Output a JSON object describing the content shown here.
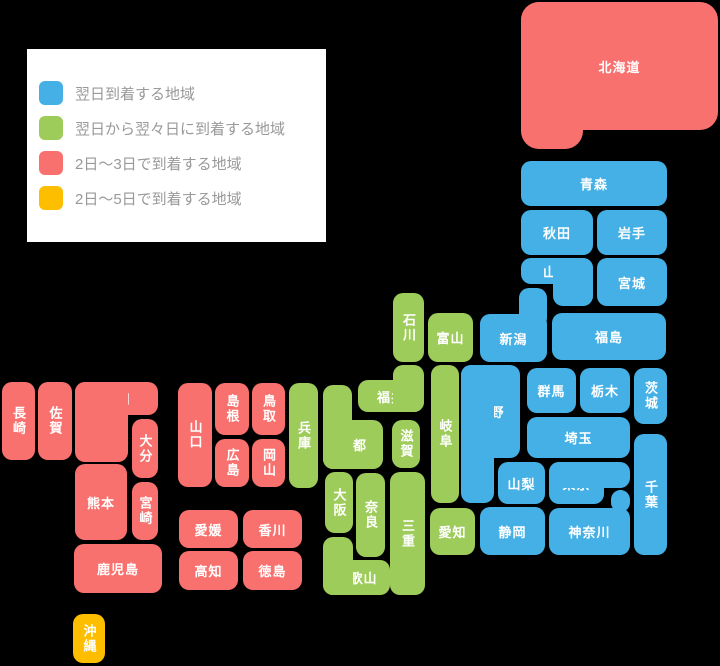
{
  "canvas": {
    "width": 720,
    "height": 666,
    "background": "#000000"
  },
  "colors": {
    "next_day": "#45B0E5",
    "next_next_day": "#9ECC5A",
    "two_three_days": "#F9716E",
    "two_five_days": "#FDBE00",
    "legend_background": "#FFFFFF",
    "legend_text": "#999999",
    "block_label": "#FFFFFF"
  },
  "legend": {
    "items": [
      {
        "key": "next_day",
        "label": "翌日到着する地域",
        "color": "#45B0E5"
      },
      {
        "key": "next_next_day",
        "label": "翌日から翌々日に到着する地域",
        "color": "#9ECC5A"
      },
      {
        "key": "two_three_days",
        "label": "2日〜3日で到着する地域",
        "color": "#F9716E"
      },
      {
        "key": "two_five_days",
        "label": "2日〜5日で到着する地域",
        "color": "#FDBE00"
      }
    ]
  },
  "map": {
    "prefectures": [
      {
        "name": "hokkaido",
        "label": "北海道",
        "delivery": "two_three_days",
        "radius": 18,
        "vertical": false,
        "rects": [
          [
            521,
            2,
            197,
            128
          ],
          [
            521,
            2,
            62,
            147
          ]
        ]
      },
      {
        "name": "aomori",
        "label": "青森",
        "delivery": "next_day",
        "vertical": false,
        "rects": [
          [
            521,
            161,
            146,
            45
          ]
        ]
      },
      {
        "name": "akita",
        "label": "秋田",
        "delivery": "next_day",
        "vertical": false,
        "rects": [
          [
            521,
            210,
            72,
            45
          ]
        ]
      },
      {
        "name": "iwate",
        "label": "岩手",
        "delivery": "next_day",
        "vertical": false,
        "rects": [
          [
            597,
            210,
            70,
            45
          ]
        ]
      },
      {
        "name": "yamagata",
        "label": "山形",
        "delivery": "next_day",
        "vertical": false,
        "rects": [
          [
            521,
            258,
            72,
            26
          ],
          [
            553,
            258,
            40,
            48
          ]
        ]
      },
      {
        "name": "miyagi",
        "label": "宮城",
        "delivery": "next_day",
        "vertical": false,
        "rects": [
          [
            597,
            258,
            70,
            48
          ]
        ]
      },
      {
        "name": "fukushima",
        "label": "福島",
        "delivery": "next_day",
        "vertical": false,
        "rects": [
          [
            552,
            313,
            114,
            47
          ]
        ]
      },
      {
        "name": "niigata",
        "label": "新潟",
        "delivery": "next_day",
        "vertical": false,
        "rects": [
          [
            480,
            314,
            67,
            48
          ],
          [
            519,
            288,
            28,
            40
          ]
        ]
      },
      {
        "name": "gunma",
        "label": "群馬",
        "delivery": "next_day",
        "vertical": false,
        "rects": [
          [
            527,
            368,
            49,
            45
          ]
        ]
      },
      {
        "name": "tochigi",
        "label": "栃木",
        "delivery": "next_day",
        "vertical": false,
        "rects": [
          [
            580,
            368,
            50,
            45
          ]
        ]
      },
      {
        "name": "ibaraki",
        "label": "茨城",
        "delivery": "next_day",
        "vertical": true,
        "rects": [
          [
            634,
            368,
            33,
            56
          ]
        ]
      },
      {
        "name": "saitama",
        "label": "埼玉",
        "delivery": "next_day",
        "vertical": false,
        "rects": [
          [
            527,
            417,
            103,
            41
          ]
        ]
      },
      {
        "name": "nagano",
        "label": "長野",
        "delivery": "next_day",
        "vertical": false,
        "rects": [
          [
            461,
            365,
            59,
            93
          ],
          [
            461,
            365,
            33,
            138
          ]
        ]
      },
      {
        "name": "yamanashi",
        "label": "山梨",
        "delivery": "next_day",
        "vertical": false,
        "rects": [
          [
            498,
            462,
            47,
            42
          ]
        ]
      },
      {
        "name": "tokyo",
        "label": "東京",
        "delivery": "next_day",
        "vertical": false,
        "rects": [
          [
            549,
            462,
            55,
            42
          ],
          [
            549,
            462,
            81,
            26
          ]
        ]
      },
      {
        "name": "chiba",
        "label": "千葉",
        "delivery": "next_day",
        "vertical": true,
        "rects": [
          [
            634,
            434,
            33,
            121
          ]
        ]
      },
      {
        "name": "shizuoka",
        "label": "静岡",
        "delivery": "next_day",
        "vertical": false,
        "rects": [
          [
            480,
            507,
            65,
            48
          ]
        ]
      },
      {
        "name": "kanagawa",
        "label": "神奈川",
        "delivery": "next_day",
        "vertical": false,
        "rects": [
          [
            549,
            508,
            81,
            47
          ],
          [
            611,
            490,
            19,
            22
          ]
        ]
      },
      {
        "name": "ishikawa",
        "label": "石川",
        "delivery": "next_next_day",
        "vertical": true,
        "rects": [
          [
            393,
            293,
            31,
            69
          ]
        ]
      },
      {
        "name": "toyama",
        "label": "富山",
        "delivery": "next_next_day",
        "vertical": false,
        "rects": [
          [
            428,
            313,
            45,
            49
          ]
        ]
      },
      {
        "name": "fukui",
        "label": "福井",
        "delivery": "next_next_day",
        "vertical": false,
        "rects": [
          [
            358,
            380,
            66,
            32
          ],
          [
            393,
            365,
            31,
            47
          ]
        ]
      },
      {
        "name": "gifu",
        "label": "岐阜",
        "delivery": "next_next_day",
        "vertical": true,
        "rects": [
          [
            431,
            365,
            28,
            138
          ]
        ]
      },
      {
        "name": "aichi",
        "label": "愛知",
        "delivery": "next_next_day",
        "vertical": false,
        "rects": [
          [
            430,
            508,
            45,
            47
          ]
        ]
      },
      {
        "name": "shiga",
        "label": "滋賀",
        "delivery": "next_next_day",
        "vertical": true,
        "rects": [
          [
            392,
            420,
            28,
            48
          ]
        ]
      },
      {
        "name": "mie",
        "label": "三重",
        "delivery": "next_next_day",
        "vertical": true,
        "rects": [
          [
            390,
            472,
            35,
            123
          ]
        ]
      },
      {
        "name": "kyoto",
        "label": "京都",
        "delivery": "next_next_day",
        "vertical": false,
        "rects": [
          [
            323,
            420,
            60,
            49
          ],
          [
            323,
            385,
            29,
            84
          ]
        ]
      },
      {
        "name": "osaka",
        "label": "大阪",
        "delivery": "next_next_day",
        "vertical": true,
        "rects": [
          [
            325,
            472,
            28,
            61
          ]
        ]
      },
      {
        "name": "nara",
        "label": "奈良",
        "delivery": "next_next_day",
        "vertical": true,
        "rects": [
          [
            356,
            473,
            29,
            84
          ]
        ]
      },
      {
        "name": "wakayama",
        "label": "和歌山",
        "delivery": "next_next_day",
        "vertical": false,
        "rects": [
          [
            323,
            560,
            67,
            35
          ],
          [
            323,
            537,
            30,
            58
          ]
        ]
      },
      {
        "name": "hyogo",
        "label": "兵庫",
        "delivery": "next_next_day",
        "vertical": true,
        "rects": [
          [
            289,
            383,
            29,
            105
          ]
        ]
      },
      {
        "name": "tottori",
        "label": "鳥取",
        "delivery": "two_three_days",
        "vertical": true,
        "rects": [
          [
            252,
            383,
            33,
            52
          ]
        ]
      },
      {
        "name": "shimane",
        "label": "島根",
        "delivery": "two_three_days",
        "vertical": true,
        "rects": [
          [
            215,
            383,
            34,
            52
          ]
        ]
      },
      {
        "name": "okayama",
        "label": "岡山",
        "delivery": "two_three_days",
        "vertical": true,
        "rects": [
          [
            252,
            439,
            33,
            48
          ]
        ]
      },
      {
        "name": "hiroshima",
        "label": "広島",
        "delivery": "two_three_days",
        "vertical": true,
        "rects": [
          [
            215,
            439,
            34,
            48
          ]
        ]
      },
      {
        "name": "yamaguchi",
        "label": "山口",
        "delivery": "two_three_days",
        "vertical": true,
        "rects": [
          [
            178,
            383,
            34,
            104
          ]
        ]
      },
      {
        "name": "kagawa",
        "label": "香川",
        "delivery": "two_three_days",
        "vertical": false,
        "rects": [
          [
            243,
            510,
            59,
            38
          ]
        ]
      },
      {
        "name": "ehime",
        "label": "愛媛",
        "delivery": "two_three_days",
        "vertical": false,
        "rects": [
          [
            179,
            510,
            59,
            38
          ]
        ]
      },
      {
        "name": "tokushima",
        "label": "徳島",
        "delivery": "two_three_days",
        "vertical": false,
        "rects": [
          [
            243,
            551,
            59,
            39
          ]
        ]
      },
      {
        "name": "kochi",
        "label": "高知",
        "delivery": "two_three_days",
        "vertical": false,
        "rects": [
          [
            179,
            551,
            59,
            39
          ]
        ]
      },
      {
        "name": "fukuoka",
        "label": "福岡",
        "delivery": "two_three_days",
        "vertical": false,
        "rects": [
          [
            75,
            382,
            83,
            33
          ],
          [
            75,
            382,
            53,
            80
          ]
        ]
      },
      {
        "name": "saga",
        "label": "佐賀",
        "delivery": "two_three_days",
        "vertical": true,
        "rects": [
          [
            38,
            382,
            34,
            78
          ]
        ]
      },
      {
        "name": "nagasaki",
        "label": "長崎",
        "delivery": "two_three_days",
        "vertical": true,
        "rects": [
          [
            2,
            382,
            33,
            78
          ]
        ]
      },
      {
        "name": "oita",
        "label": "大分",
        "delivery": "two_three_days",
        "vertical": true,
        "rects": [
          [
            132,
            419,
            26,
            59
          ]
        ]
      },
      {
        "name": "kumamoto",
        "label": "熊本",
        "delivery": "two_three_days",
        "vertical": false,
        "rects": [
          [
            75,
            464,
            52,
            76
          ]
        ]
      },
      {
        "name": "miyazaki",
        "label": "宮崎",
        "delivery": "two_three_days",
        "vertical": true,
        "rects": [
          [
            132,
            482,
            26,
            58
          ]
        ]
      },
      {
        "name": "kagoshima",
        "label": "鹿児島",
        "delivery": "two_three_days",
        "vertical": false,
        "rects": [
          [
            74,
            544,
            88,
            49
          ]
        ]
      },
      {
        "name": "okinawa",
        "label": "沖縄",
        "delivery": "two_five_days",
        "vertical": true,
        "rects": [
          [
            73,
            614,
            32,
            49
          ]
        ]
      }
    ]
  }
}
